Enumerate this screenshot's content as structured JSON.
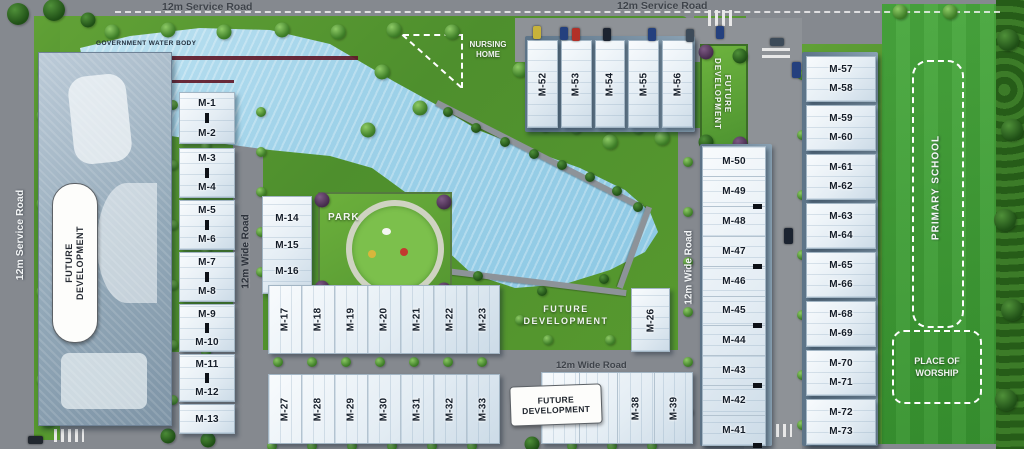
{
  "roads": {
    "top_left": "12m Service Road",
    "top_right": "12m Service Road",
    "left": "12m Service Road",
    "inner_left": "12m Wide Road",
    "inner_right": "12m Wide Road",
    "inner_bottom": "12m Wide Road"
  },
  "areas": {
    "government_water_body": "GOVERNMENT WATER BODY",
    "park": "PARK",
    "nursing_home_lines": [
      "NURSING",
      "HOME"
    ],
    "primary_school": "PRIMARY SCHOOL",
    "place_of_worship_lines": [
      "PLACE OF",
      "WORSHIP"
    ],
    "future_development_lines": [
      "FUTURE",
      "DEVELOPMENT"
    ]
  },
  "blocks": {
    "west_column": [
      "M-1",
      "M-2",
      "M-3",
      "M-4",
      "M-5",
      "M-6",
      "M-7",
      "M-8",
      "M-9",
      "M-10",
      "M-11",
      "M-12",
      "M-13"
    ],
    "mid_column": [
      "M-14",
      "M-15",
      "M-16"
    ],
    "row_17_23": [
      "M-17",
      "M-18",
      "M-19",
      "M-20",
      "M-21",
      "M-22",
      "M-23"
    ],
    "row_27_33": [
      "M-27",
      "M-28",
      "M-29",
      "M-30",
      "M-31",
      "M-32",
      "M-33"
    ],
    "row_36_39": [
      "M-36",
      "M-37",
      "M-38",
      "M-39"
    ],
    "block_26": "M-26",
    "east_column_top_to_bottom": [
      "M-50",
      "M-49",
      "M-48",
      "M-47",
      "M-46",
      "M-45",
      "M-44",
      "M-43",
      "M-42",
      "M-41"
    ],
    "north_row": [
      "M-52",
      "M-53",
      "M-54",
      "M-55",
      "M-56"
    ],
    "far_east_column": [
      "M-57",
      "M-58",
      "M-59",
      "M-60",
      "M-61",
      "M-62",
      "M-63",
      "M-64",
      "M-65",
      "M-66",
      "M-68",
      "M-69",
      "M-70",
      "M-71",
      "M-72",
      "M-73"
    ]
  },
  "colors": {
    "water": "#9fd2e9",
    "grass": "#57992f",
    "playfield": "#3f9e37",
    "road": "#85898f",
    "building": "#f2f7fa",
    "label_ink": "#141d29",
    "boundary_wall": "#5f1626"
  }
}
